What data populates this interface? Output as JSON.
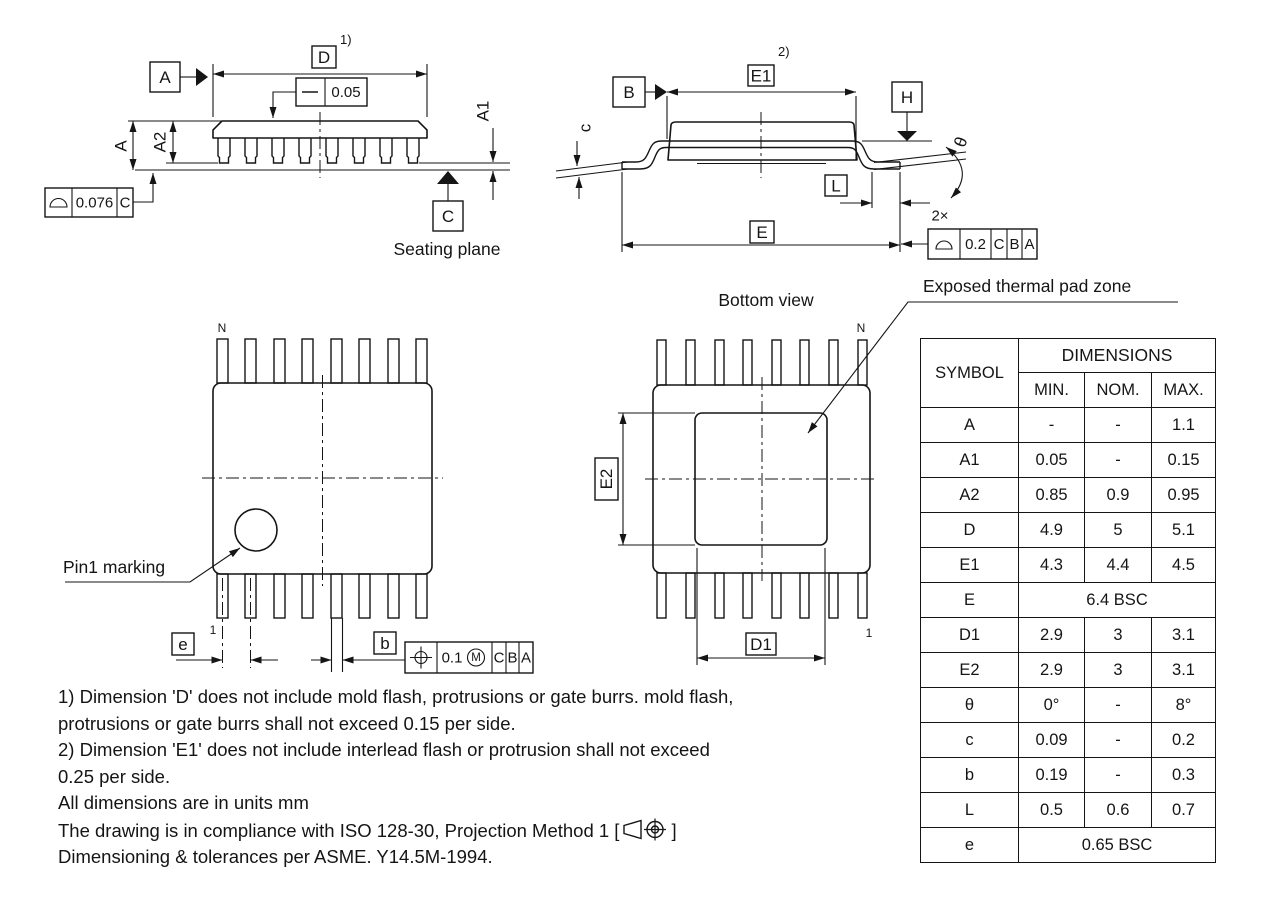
{
  "drawing": {
    "side_view": {
      "datum_a": "A",
      "dim_d": "D",
      "note_ref_1": "1)",
      "straightness_value": "0.05",
      "dim_a": "A",
      "dim_a2": "A2",
      "dim_a1": "A1",
      "profile_value": "0.076",
      "profile_datum": "C",
      "datum_c": "C",
      "seating_plane_label": "Seating plane"
    },
    "end_view": {
      "datum_b": "B",
      "dim_e1": "E1",
      "note_ref_2": "2)",
      "datum_h": "H",
      "dim_c": "c",
      "dim_theta": "θ",
      "dim_l": "L",
      "dim_e": "E",
      "count_2x": "2×",
      "fcf": {
        "value": "0.2",
        "d1": "C",
        "d2": "B",
        "d3": "A"
      }
    },
    "top_view": {
      "pin_n": "N",
      "pin_1": "1",
      "pin1_marking_label": "Pin1 marking",
      "dim_e_pitch": "e",
      "dim_b": "b",
      "fcf": {
        "value": "0.1",
        "modifier": "M",
        "d1": "C",
        "d2": "B",
        "d3": "A"
      }
    },
    "bottom_view": {
      "title": "Bottom view",
      "pad_label": "Exposed thermal pad zone",
      "pin_n": "N",
      "pin_1": "1",
      "dim_e2": "E2",
      "dim_d1": "D1"
    }
  },
  "table": {
    "symbol_header": "SYMBOL",
    "dimensions_header": "DIMENSIONS",
    "min_header": "MIN.",
    "nom_header": "NOM.",
    "max_header": "MAX.",
    "rows": [
      {
        "symbol": "A",
        "min": "-",
        "nom": "-",
        "max": "1.1"
      },
      {
        "symbol": "A1",
        "min": "0.05",
        "nom": "-",
        "max": "0.15"
      },
      {
        "symbol": "A2",
        "min": "0.85",
        "nom": "0.9",
        "max": "0.95"
      },
      {
        "symbol": "D",
        "min": "4.9",
        "nom": "5",
        "max": "5.1"
      },
      {
        "symbol": "E1",
        "min": "4.3",
        "nom": "4.4",
        "max": "4.5"
      },
      {
        "symbol": "E",
        "span": "6.4 BSC"
      },
      {
        "symbol": "D1",
        "min": "2.9",
        "nom": "3",
        "max": "3.1"
      },
      {
        "symbol": "E2",
        "min": "2.9",
        "nom": "3",
        "max": "3.1"
      },
      {
        "symbol": "θ",
        "min": "0°",
        "nom": "-",
        "max": "8°"
      },
      {
        "symbol": "c",
        "min": "0.09",
        "nom": "-",
        "max": "0.2"
      },
      {
        "symbol": "b",
        "min": "0.19",
        "nom": "-",
        "max": "0.3"
      },
      {
        "symbol": "L",
        "min": "0.5",
        "nom": "0.6",
        "max": "0.7"
      },
      {
        "symbol": "e",
        "span": "0.65 BSC"
      }
    ]
  },
  "notes": {
    "line1": "1) Dimension 'D' does not include mold flash, protrusions or gate burrs. mold flash,",
    "line2": "protrusions or gate burrs shall not exceed 0.15 per side.",
    "line3": "2) Dimension 'E1' does not include interlead flash or protrusion shall not exceed",
    "line4": "0.25 per side.",
    "line5": "All dimensions are in units mm",
    "line6_prefix": "The drawing is in compliance with ISO 128-30, Projection Method 1 [",
    "line6_suffix": "]",
    "line7": "Dimensioning & tolerances per ASME. Y14.5M-1994."
  },
  "colors": {
    "line": "#151515",
    "background": "#ffffff"
  }
}
